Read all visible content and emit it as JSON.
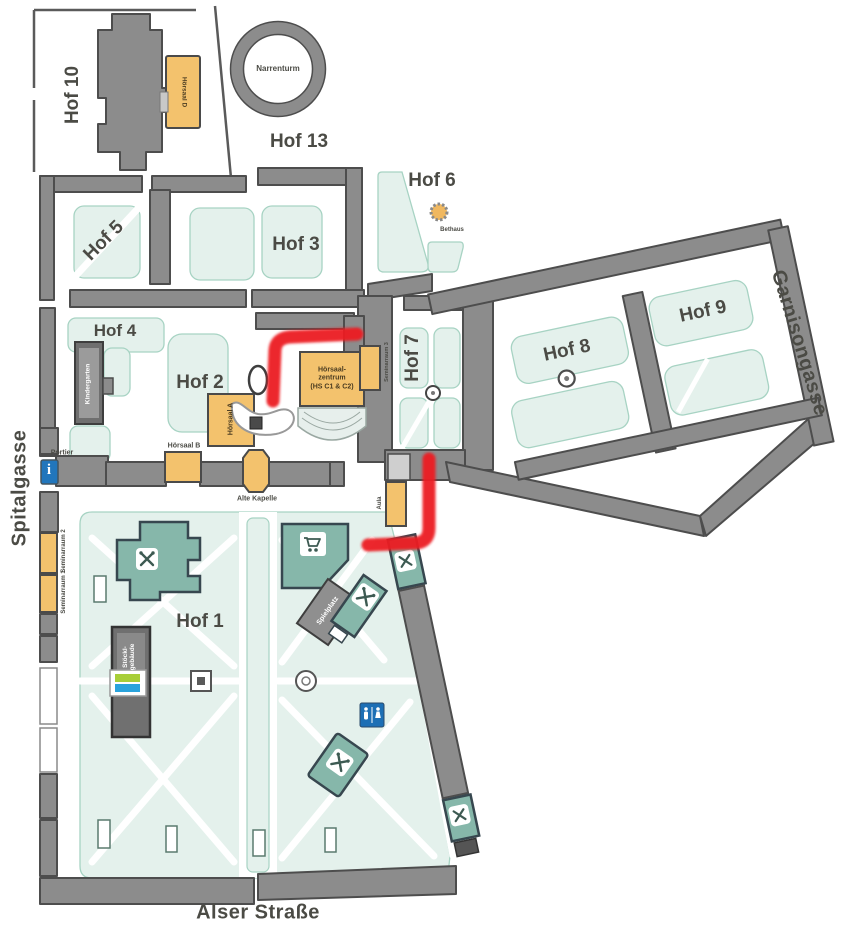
{
  "streets": {
    "spitalgasse": "Spitalgasse",
    "alser_strasse": "Alser Straße",
    "garnisongasse": "Garnisongasse"
  },
  "courtyards": {
    "hof1": "Hof 1",
    "hof2": "Hof 2",
    "hof3": "Hof 3",
    "hof4": "Hof 4",
    "hof5": "Hof 5",
    "hof6": "Hof 6",
    "hof7": "Hof 7",
    "hof8": "Hof 8",
    "hof9": "Hof 9",
    "hof10": "Hof 10",
    "hof13": "Hof 13"
  },
  "buildings": {
    "narrenturm": "Narrenturm",
    "bethaus": "Bethaus",
    "hoersaal_a": "Hörsaal A",
    "hoersaal_b": "Hörsaal B",
    "hoersaal_d": "Hörsaal D",
    "hoersaalzentrum_line1": "Hörsaal-",
    "hoersaalzentrum_line2": "zentrum",
    "hoersaalzentrum_line3": "(HS C1 & C2)",
    "alte_kapelle": "Alte Kapelle",
    "portier": "Portier",
    "aula": "Aula",
    "kindergarten": "Kindergarten",
    "seminarraum1": "Seminarraum 1",
    "seminarraum2": "Seminarraum 2",
    "seminarraum3": "Seminarraum 3",
    "spielplatz": "Spielplatz",
    "stoecklgebaeude_line1": "Stöckl-",
    "stoecklgebaeude_line2": "gebäude"
  },
  "icons": {
    "info_glyph": "i",
    "info_icon": "information-point",
    "wc_icon": "restrooms",
    "restaurant_icon": "food-service",
    "cart_icon": "shop",
    "recycling_icon": "recycling-station",
    "fountain_icon": "fountain"
  },
  "colors": {
    "wall_gray": "#8c8c8c",
    "wall_outline": "#4d4d4d",
    "dark_building": "#6f6f6f",
    "lawn_green": "#e4f1ec",
    "lawn_outline": "#a7d3c3",
    "teal_building": "#86b7aa",
    "orange_building": "#f3c26d",
    "route_red": "#ec1b24",
    "info_blue": "#2176bc",
    "wc_blue": "#1d6fb5",
    "label_dark": "#4b4b45"
  },
  "route": {
    "color": "#ec1b24"
  }
}
